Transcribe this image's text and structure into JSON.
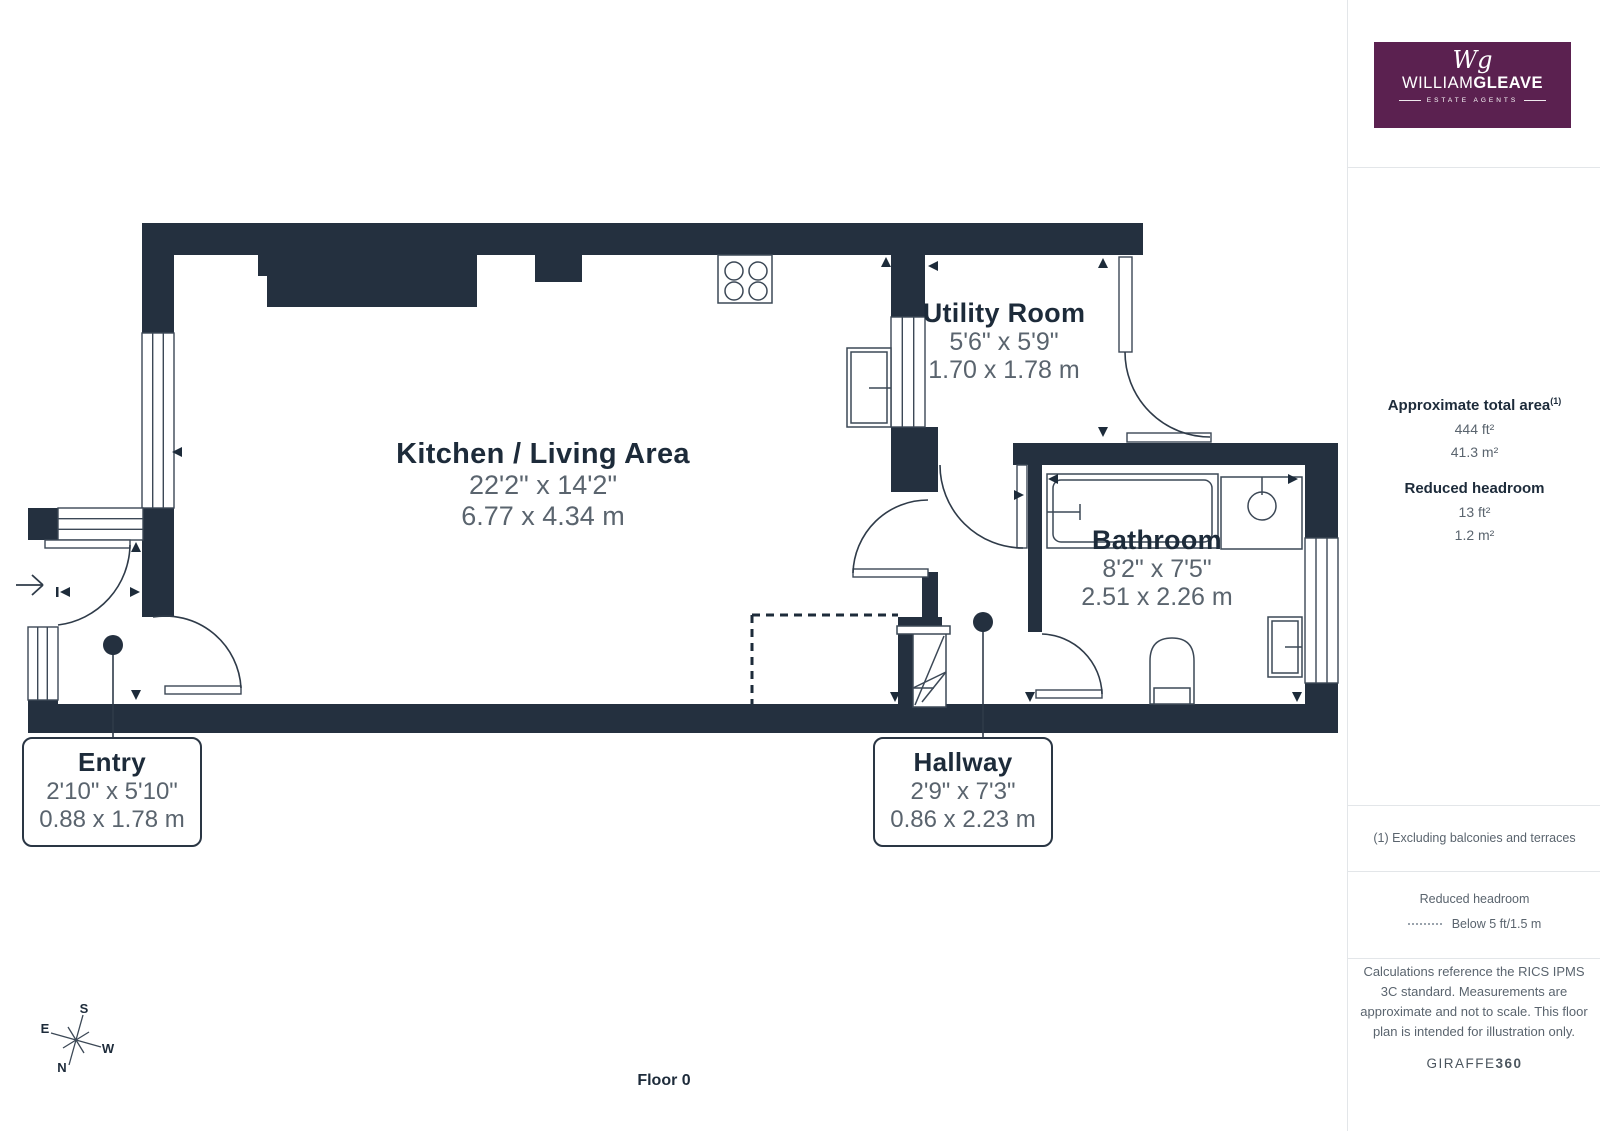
{
  "logo": {
    "monogram": "Wg",
    "name_light": "WILLIAM",
    "name_bold": "GLEAVE",
    "tagline": "ESTATE AGENTS"
  },
  "sidebar": {
    "total_area_title": "Approximate total area",
    "total_area_note_ref": "(1)",
    "total_area_ft": "444 ft²",
    "total_area_m": "41.3 m²",
    "reduced_headroom_title": "Reduced headroom",
    "reduced_headroom_ft": "13 ft²",
    "reduced_headroom_m": "1.2 m²",
    "footnote": "(1) Excluding balconies and terraces",
    "legend_title": "Reduced headroom",
    "legend_value": "Below 5 ft/1.5 m",
    "disclaimer": "Calculations reference the RICS IPMS 3C standard. Measurements are approximate and not to scale. This floor plan is intended for illustration only.",
    "brand_name": "GIRAFFE",
    "brand_suffix": "360"
  },
  "plan": {
    "rooms": [
      {
        "name": "Kitchen / Living Area",
        "imperial": "22'2\" x 14'2\"",
        "metric": "6.77 x 4.34 m"
      },
      {
        "name": "Utility Room",
        "imperial": "5'6\" x 5'9\"",
        "metric": "1.70 x 1.78 m"
      },
      {
        "name": "Bathroom",
        "imperial": "8'2\" x 7'5\"",
        "metric": "2.51 x 2.26 m"
      }
    ],
    "callouts": [
      {
        "name": "Entry",
        "imperial": "2'10\" x 5'10\"",
        "metric": "0.88 x 1.78 m"
      },
      {
        "name": "Hallway",
        "imperial": "2'9\" x 7'3\"",
        "metric": "0.86 x 2.23 m"
      }
    ]
  },
  "floor_label": "Floor 0",
  "compass": {
    "n": "N",
    "e": "E",
    "s": "S",
    "w": "W"
  },
  "colors": {
    "wall": "#24303f",
    "accent_purple": "#5b2150",
    "text_dark": "#1d2b3a",
    "text_gray": "#5a646e"
  }
}
